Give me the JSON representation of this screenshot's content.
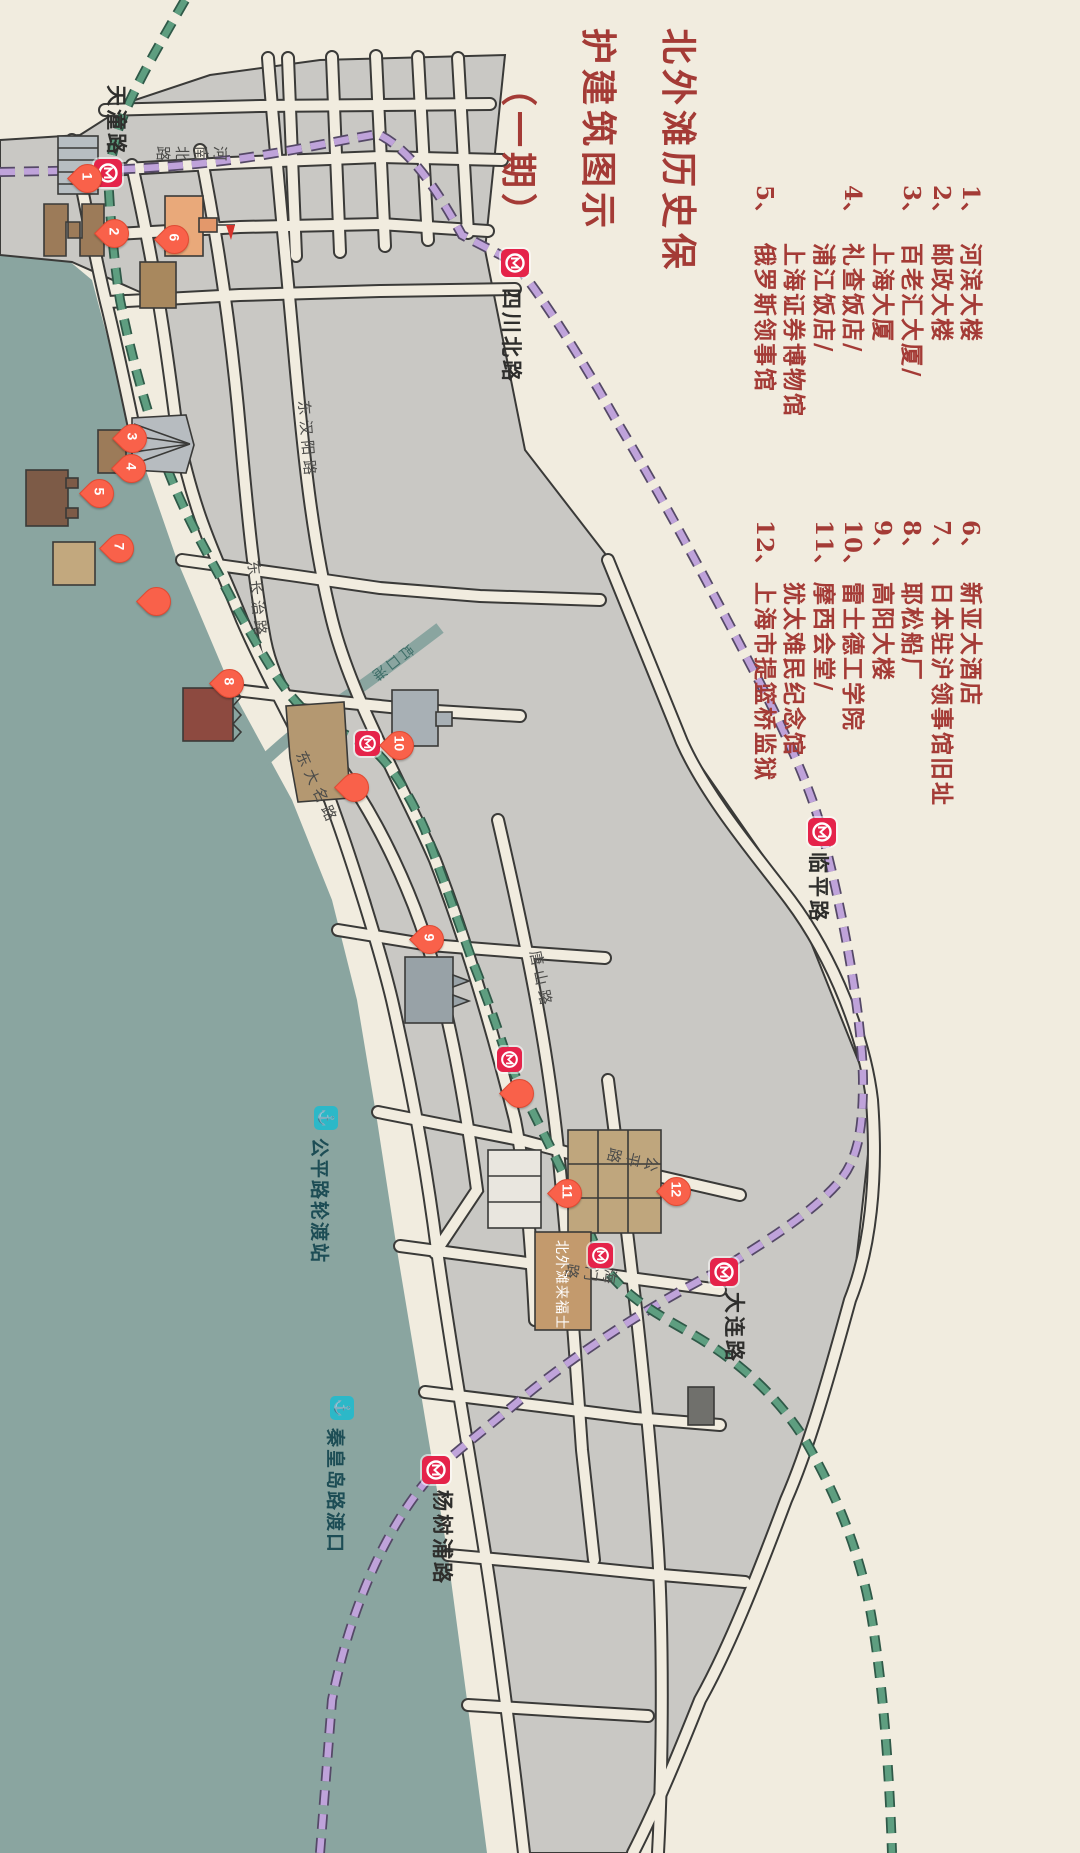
{
  "title": {
    "line1": "北外滩历史保",
    "line2": "护建筑图示",
    "line3": "（一期）"
  },
  "legend_primary": {
    "rows": [
      {
        "num": "1、",
        "text": "河滨大楼"
      },
      {
        "num": "2、",
        "text": "邮政大楼"
      },
      {
        "num": "3、",
        "text": "百老汇大厦/"
      },
      {
        "num": "",
        "text": "上海大厦"
      },
      {
        "num": "4、",
        "text": "礼查饭店/"
      },
      {
        "num": "",
        "text": "浦江饭店/"
      },
      {
        "num": "",
        "text": "上海证券博物馆"
      },
      {
        "num": "5、",
        "text": "俄罗斯领事馆"
      }
    ]
  },
  "legend_secondary": {
    "rows": [
      {
        "num": "6、",
        "text": "新亚大酒店"
      },
      {
        "num": "7、",
        "text": "日本驻沪领事馆旧址"
      },
      {
        "num": "8、",
        "text": "耶松船厂"
      },
      {
        "num": "9、",
        "text": "高阳大楼"
      },
      {
        "num": "10、",
        "text": "雷士德工学院"
      },
      {
        "num": "11、",
        "text": "摩西会堂/"
      },
      {
        "num": "",
        "text": "犹太难民纪念馆"
      },
      {
        "num": "12、",
        "text": "上海市提篮桥监狱"
      }
    ]
  },
  "stations": {
    "tiantong": "天潼路",
    "sichuan": "四川北路",
    "linping": "临平路",
    "dalian": "大连路",
    "yangshupu": "杨树浦路"
  },
  "ferries": {
    "gongping": "公平路轮渡站",
    "qinhuangdao": "秦皇岛路渡口"
  },
  "roads": {
    "henan": "河南北路",
    "changzhi": "东长治路",
    "daming": "东大名路",
    "hanyang": "东汉阳路",
    "tangshan": "唐山路",
    "gongping": "公平路",
    "haimen": "海门路",
    "hongkougang": "虹口港"
  },
  "buildings": {
    "raffles": "北外滩来福士"
  },
  "pins": {
    "p1": "1",
    "p2": "2",
    "p3": "3",
    "p4": "4",
    "p5": "5",
    "p6": "6",
    "p7": "7",
    "p8": "8",
    "p9": "9",
    "p10": "10",
    "p11": "11",
    "p12": "12",
    "plain": ""
  },
  "icons": {
    "ferry_glyph": "⚓"
  },
  "colors": {
    "background": "#f1ecdf",
    "block_gray": "#c9c8c4",
    "outline": "#3a3a38",
    "river": "#8aa5a0",
    "metro_purple": "#bfa3da",
    "metro_green": "#5e9e80",
    "metro_logo_red": "#e5234a",
    "pin_red": "#f9614a",
    "legend_red": "#a43b36",
    "ferry_cyan": "#2cb8c8"
  }
}
